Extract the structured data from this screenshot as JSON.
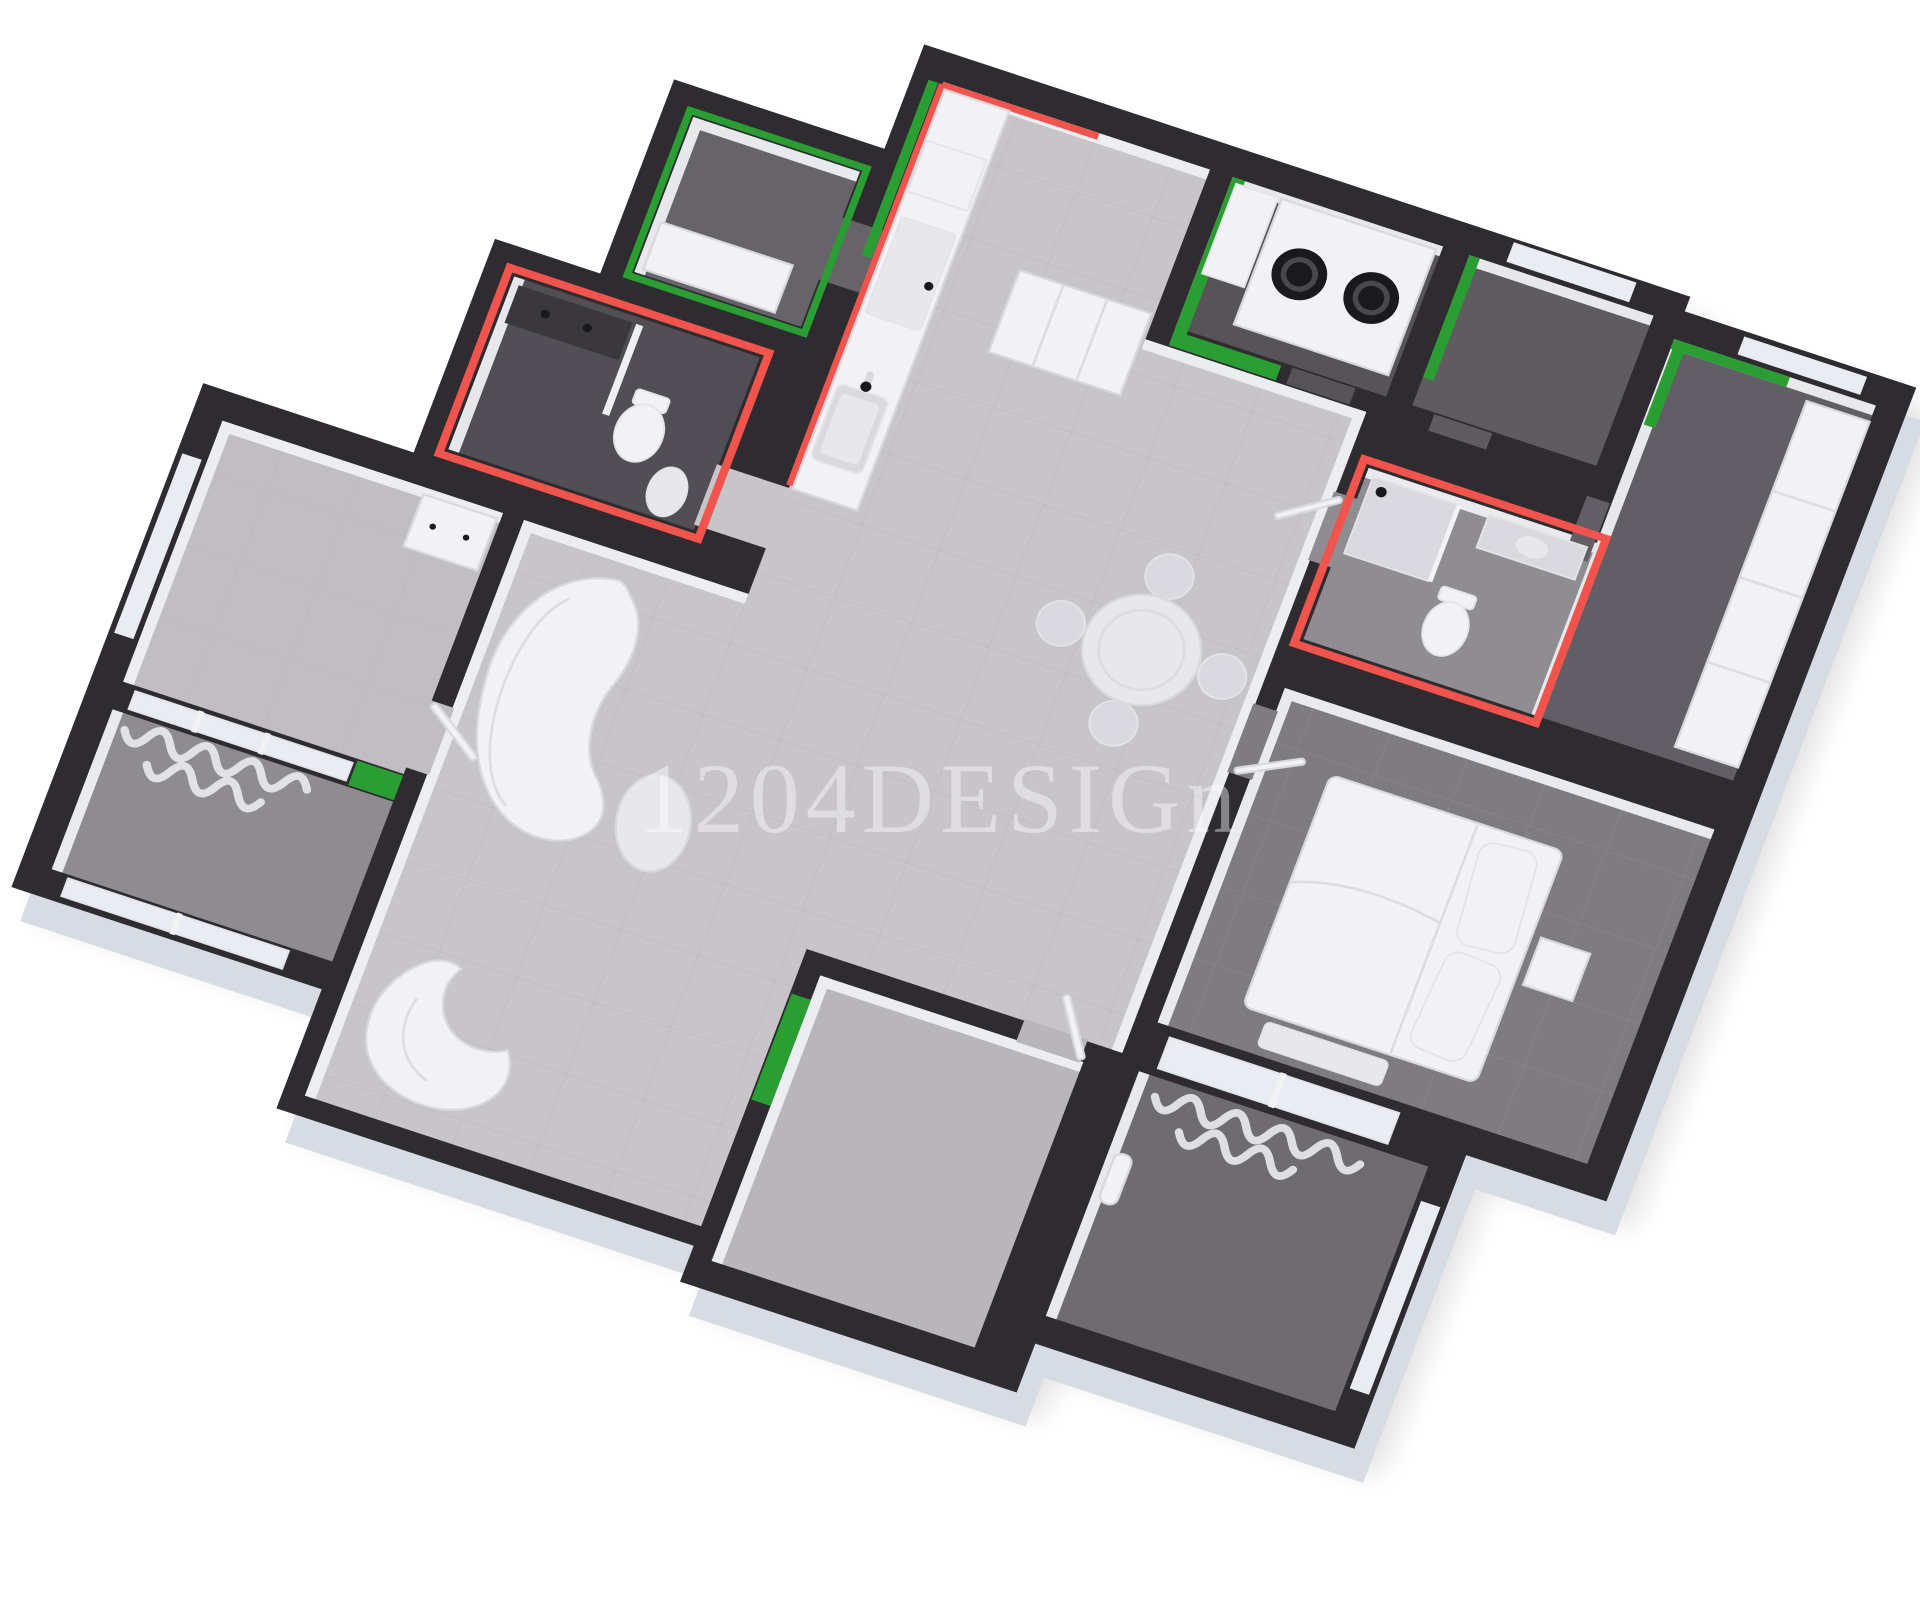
{
  "watermark": {
    "text": "1204DESIGn"
  },
  "colors": {
    "background": "#ffffff",
    "shadow": "#000000",
    "wall": "#2e2c30",
    "wall_rim": "#d7dbe4",
    "inner_face": "#eef0f4",
    "floor_living": "#c8c5c9",
    "floor_bedroom_left": "#c1bec2",
    "floor_room_bottom": "#b9b6ba",
    "floor_bath_main": "#514f55",
    "floor_green_room": "#676469",
    "floor_utility": "#565359",
    "floor_storage": "#5e5b61",
    "floor_corner": "#615e65",
    "floor_bath_ensuite": "#8f8c92",
    "floor_bedroom_right": "#7e7b81",
    "floor_balcony_left": "#8f8c91",
    "floor_balcony_right": "#6e6b71",
    "accent_green": "#2a9e33",
    "accent_red": "#f1544c",
    "furniture_white": "#f2f2f5",
    "furniture_soft": "#e7e7ec",
    "furniture_mid": "#d9d9df",
    "vanity_dark": "#3a383d",
    "appliance_dark": "#1a191d",
    "tile_line": "#b2afb4",
    "window_glass": "#e9ecf2",
    "curtain": "#e8e8ee",
    "watermark": "#ffffff"
  }
}
